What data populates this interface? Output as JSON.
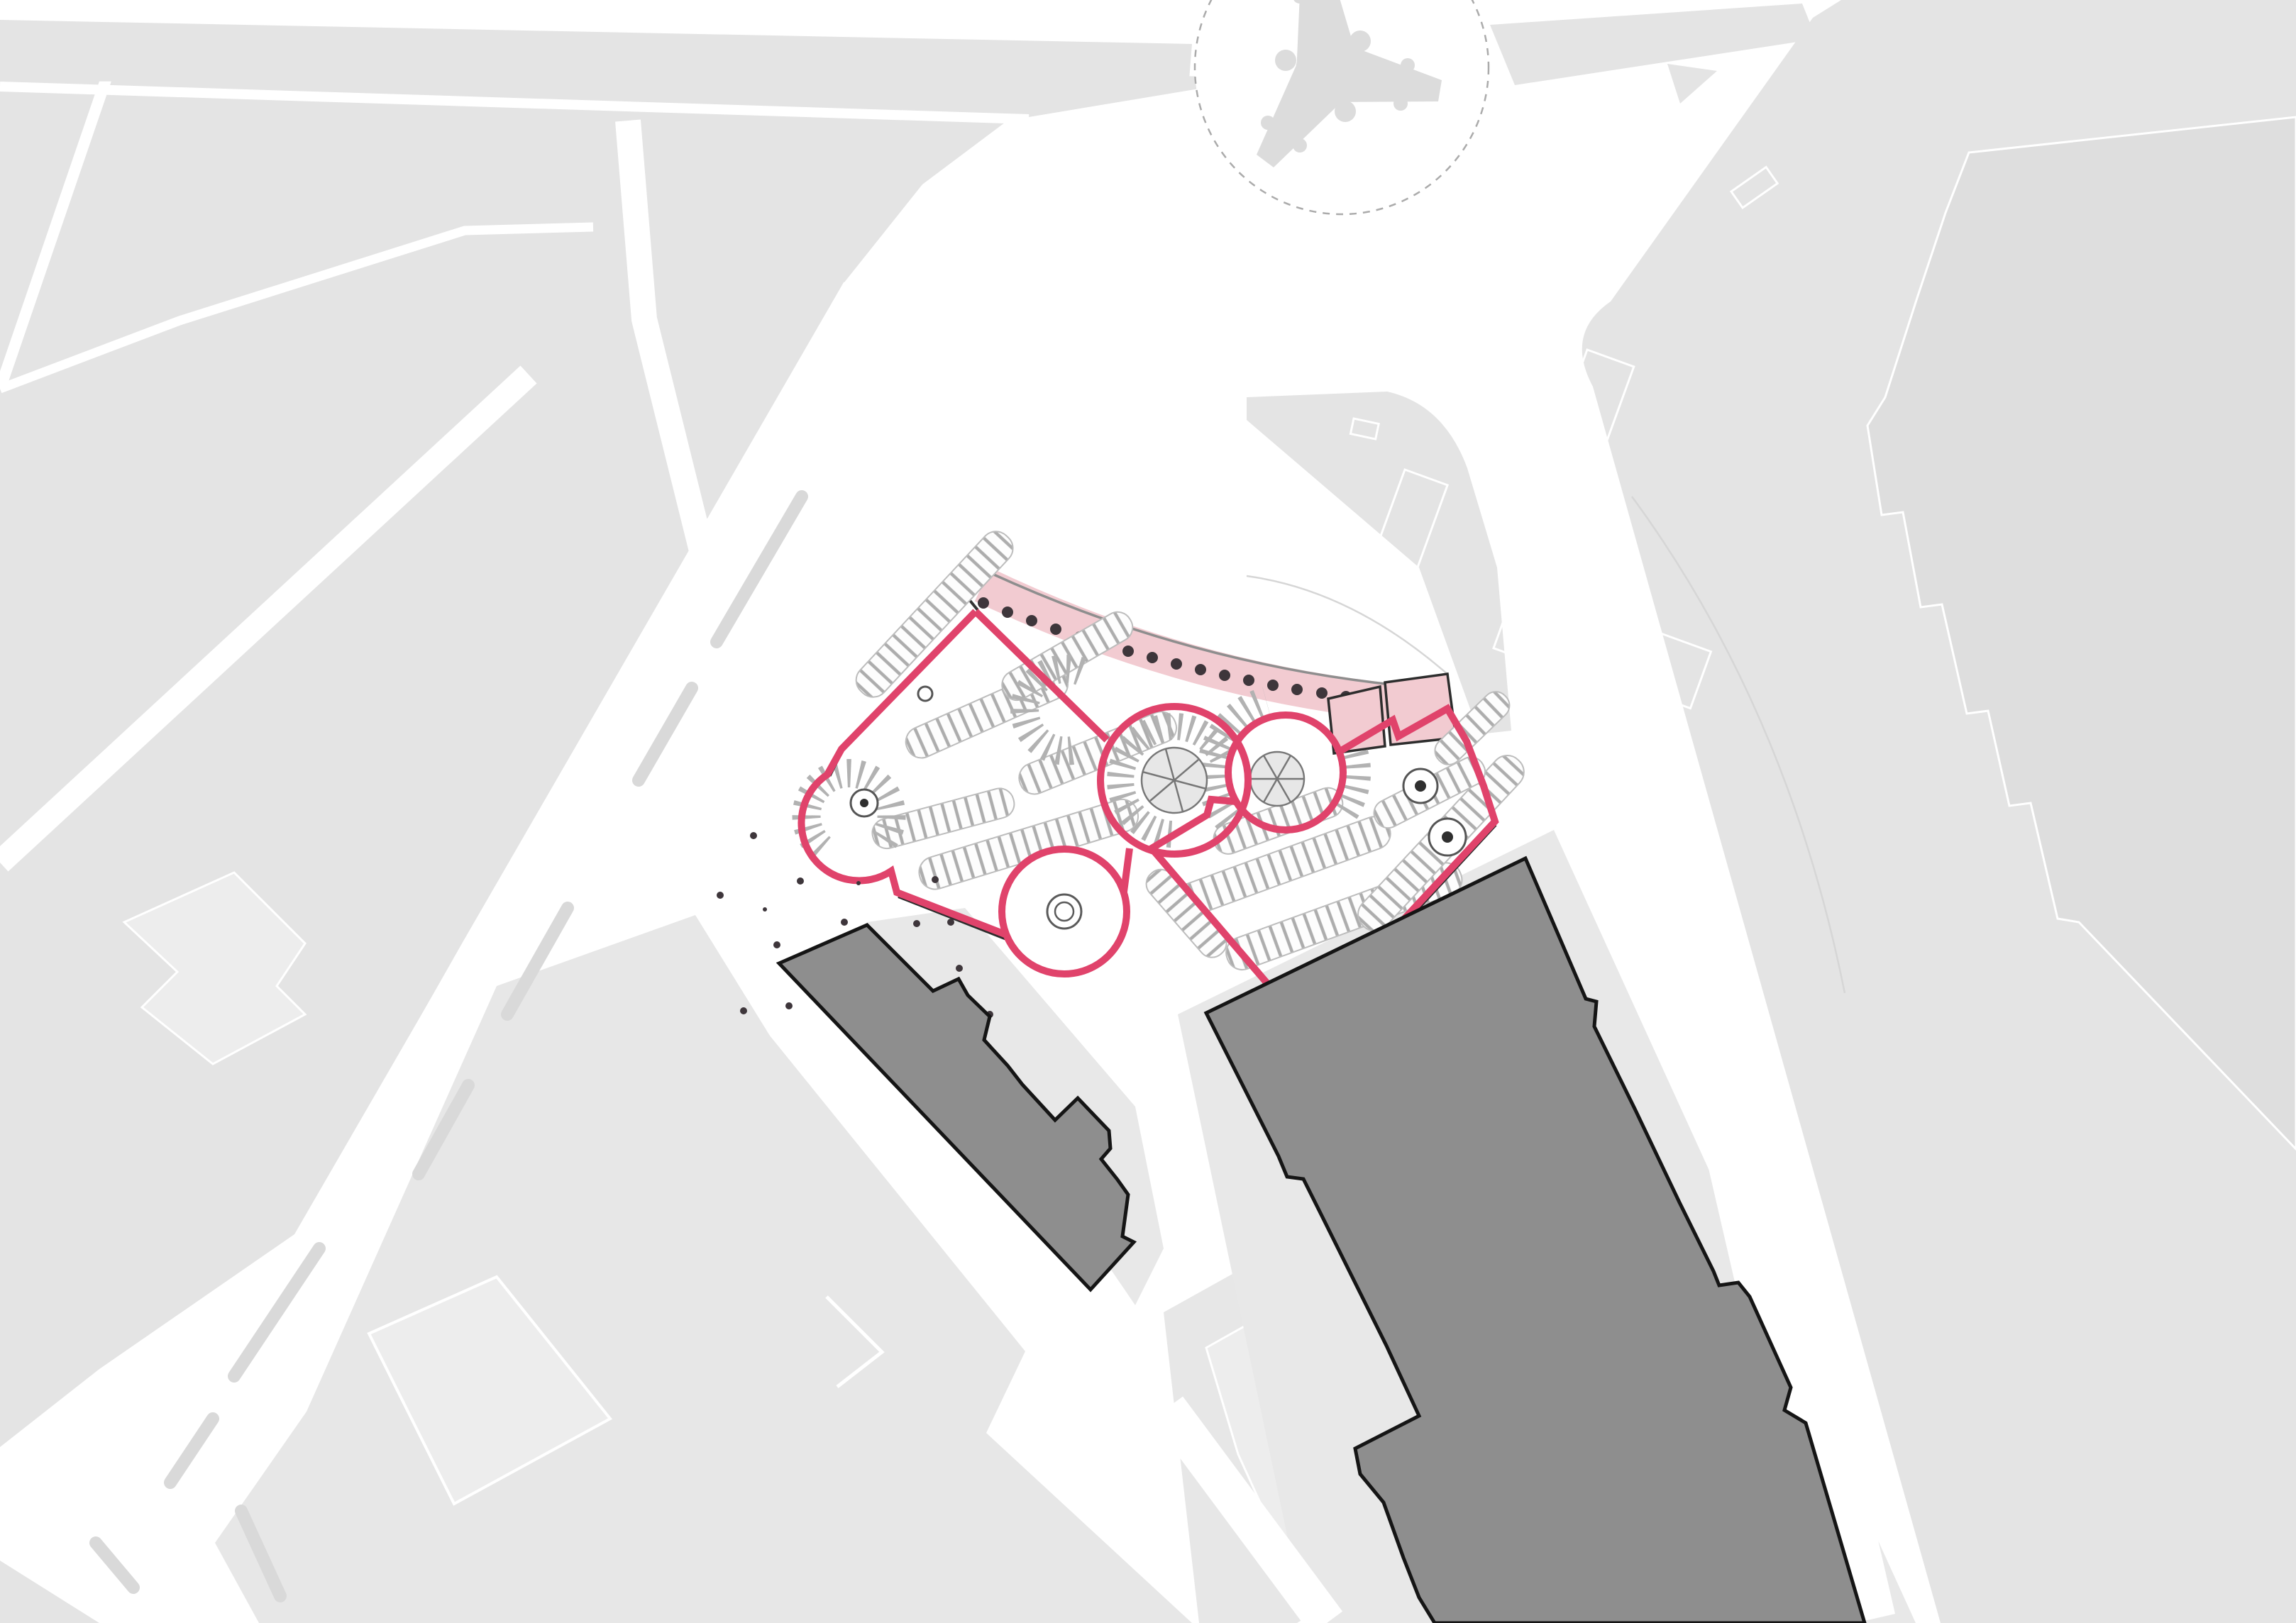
{
  "document": {
    "type": "architectural-site-plan",
    "description": "Black-and-white city figure-ground plan with an inserted underground parking garage drawing outlined in red; curved arcade strip tinted pink; two site buildings filled dark grey; roundabout with three-armed monument footprint at top.",
    "visible_text": "none legible (micro-annotations in garage drawing are illegible at this scale)"
  },
  "colors": {
    "background": "#ffffff",
    "block_gray": "#e4e4e4",
    "block_gray_2": "#e7e7e7",
    "plaza_gray": "#e8e8e8",
    "inner_building_light": "#ededed",
    "inner_building_dark": "#dedede",
    "median_gray": "#d9d9d9",
    "curb_line": "#d4d4d4",
    "building_fill": "#8e8e8e",
    "building_outline": "#151515",
    "boundary_red": "#e0436b",
    "arcade_pink": "#f2cbd1",
    "arcade_edge_gray": "#8e8e8e",
    "arcade_room_outline": "#2d2d2d",
    "hatch_gray": "#adadad",
    "fan_gray": "#b2b2b2",
    "pie_fill": "#e7e7e7",
    "pie_stroke": "#777777",
    "stair_ring": "#555555",
    "stair_dot": "#2f2f2f",
    "tree_dot": "#3e363b",
    "dark_edge": "#2d2d2d",
    "roundabout_dash": "#ababab",
    "monument_gray": "#dcdcdc",
    "white": "#ffffff"
  },
  "map": {
    "roundabout": {
      "shape": "circle",
      "border_style": "dashed",
      "monument_arms": 3,
      "monument_shape": "tapered three-armed star with side bulges"
    },
    "garage_site": {
      "boundary_color_token": "boundary_red",
      "parcels": 2,
      "ramp_circles": 3,
      "corner_ramp_fans": 2,
      "fountain_circle_with_double_ring": 1,
      "stair_cores": 4,
      "parking_rows_left_parcel": 6,
      "parking_rows_right_parcel": 7,
      "arcade": {
        "curved": true,
        "tree_dots": 17,
        "pink_rooms": 2
      },
      "scattered_plaza_trees": 16
    },
    "site_buildings": {
      "count": 2,
      "style": "dark grey fill, black outline, notched footprints"
    },
    "context": {
      "city_blocks": "light grey with white streets",
      "avenues": "wide white diagonals with grey median islands",
      "traffic_island_markings": 3
    }
  }
}
